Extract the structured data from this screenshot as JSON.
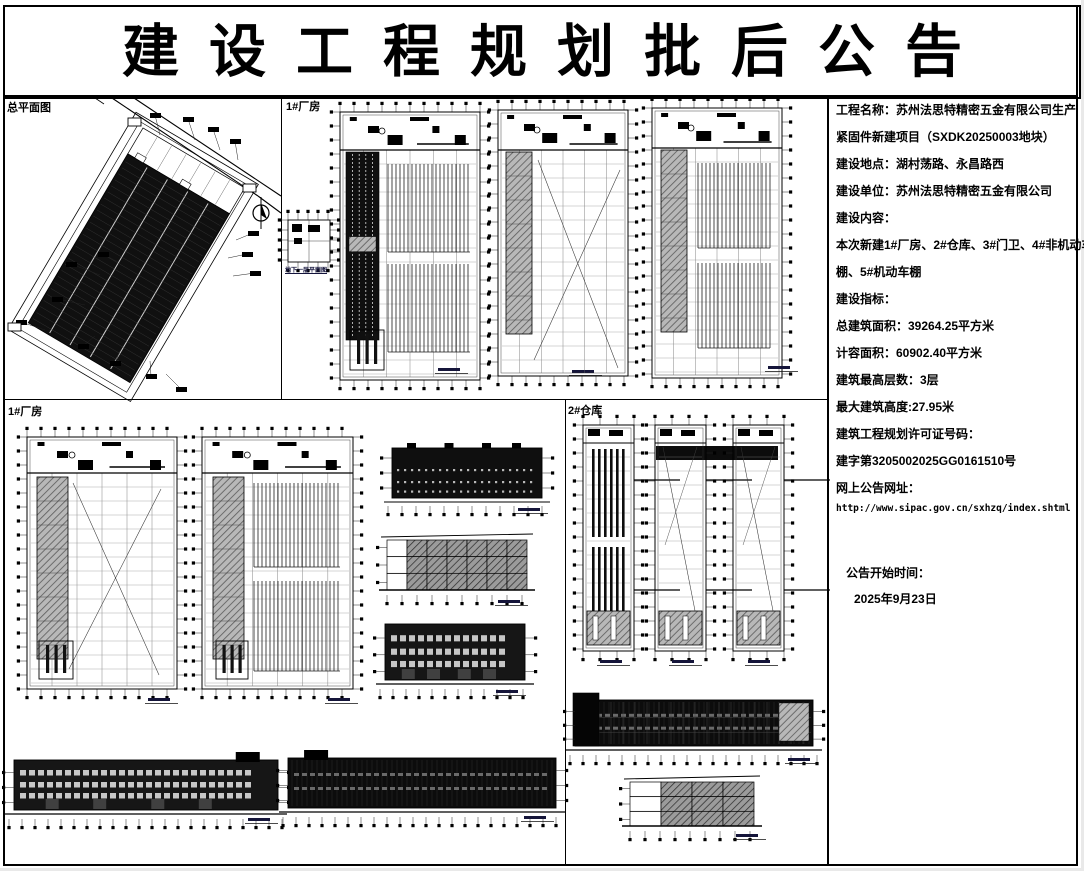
{
  "title": "建设工程规划批后公告",
  "panels": {
    "site": {
      "label": "总平面图"
    },
    "factory_top": {
      "label": "1#厂房",
      "basement_caption": "地下一层平面图"
    },
    "factory_bottom": {
      "label": "1#厂房"
    },
    "warehouse": {
      "label": "2#仓库"
    }
  },
  "info": {
    "lines": [
      "工程名称：苏州法思特精密五金有限公司生产",
      "紧固件新建项目（SXDK20250003地块）",
      "建设地点：湖村荡路、永昌路西",
      "建设单位：苏州法思特精密五金有限公司",
      "建设内容：",
      "本次新建1#厂房、2#仓库、3#门卫、4#非机动车",
      "棚、5#机动车棚",
      "建设指标：",
      "总建筑面积：39264.25平方米",
      "计容面积：60902.40平方米",
      "建筑最高层数：3层",
      "最大建筑高度:27.95米",
      "建筑工程规划许可证号码：",
      "建字第3205002025GG0161510号",
      "网上公告网址："
    ],
    "url": "http://www.sipac.gov.cn/sxhzq/index.shtml",
    "notice_time_label": "公告开始时间：",
    "notice_date": "2025年9月23日"
  },
  "colors": {
    "ink": "#000000",
    "hatch_gray": "#b8b8b8",
    "dark_fill": "#101010"
  }
}
